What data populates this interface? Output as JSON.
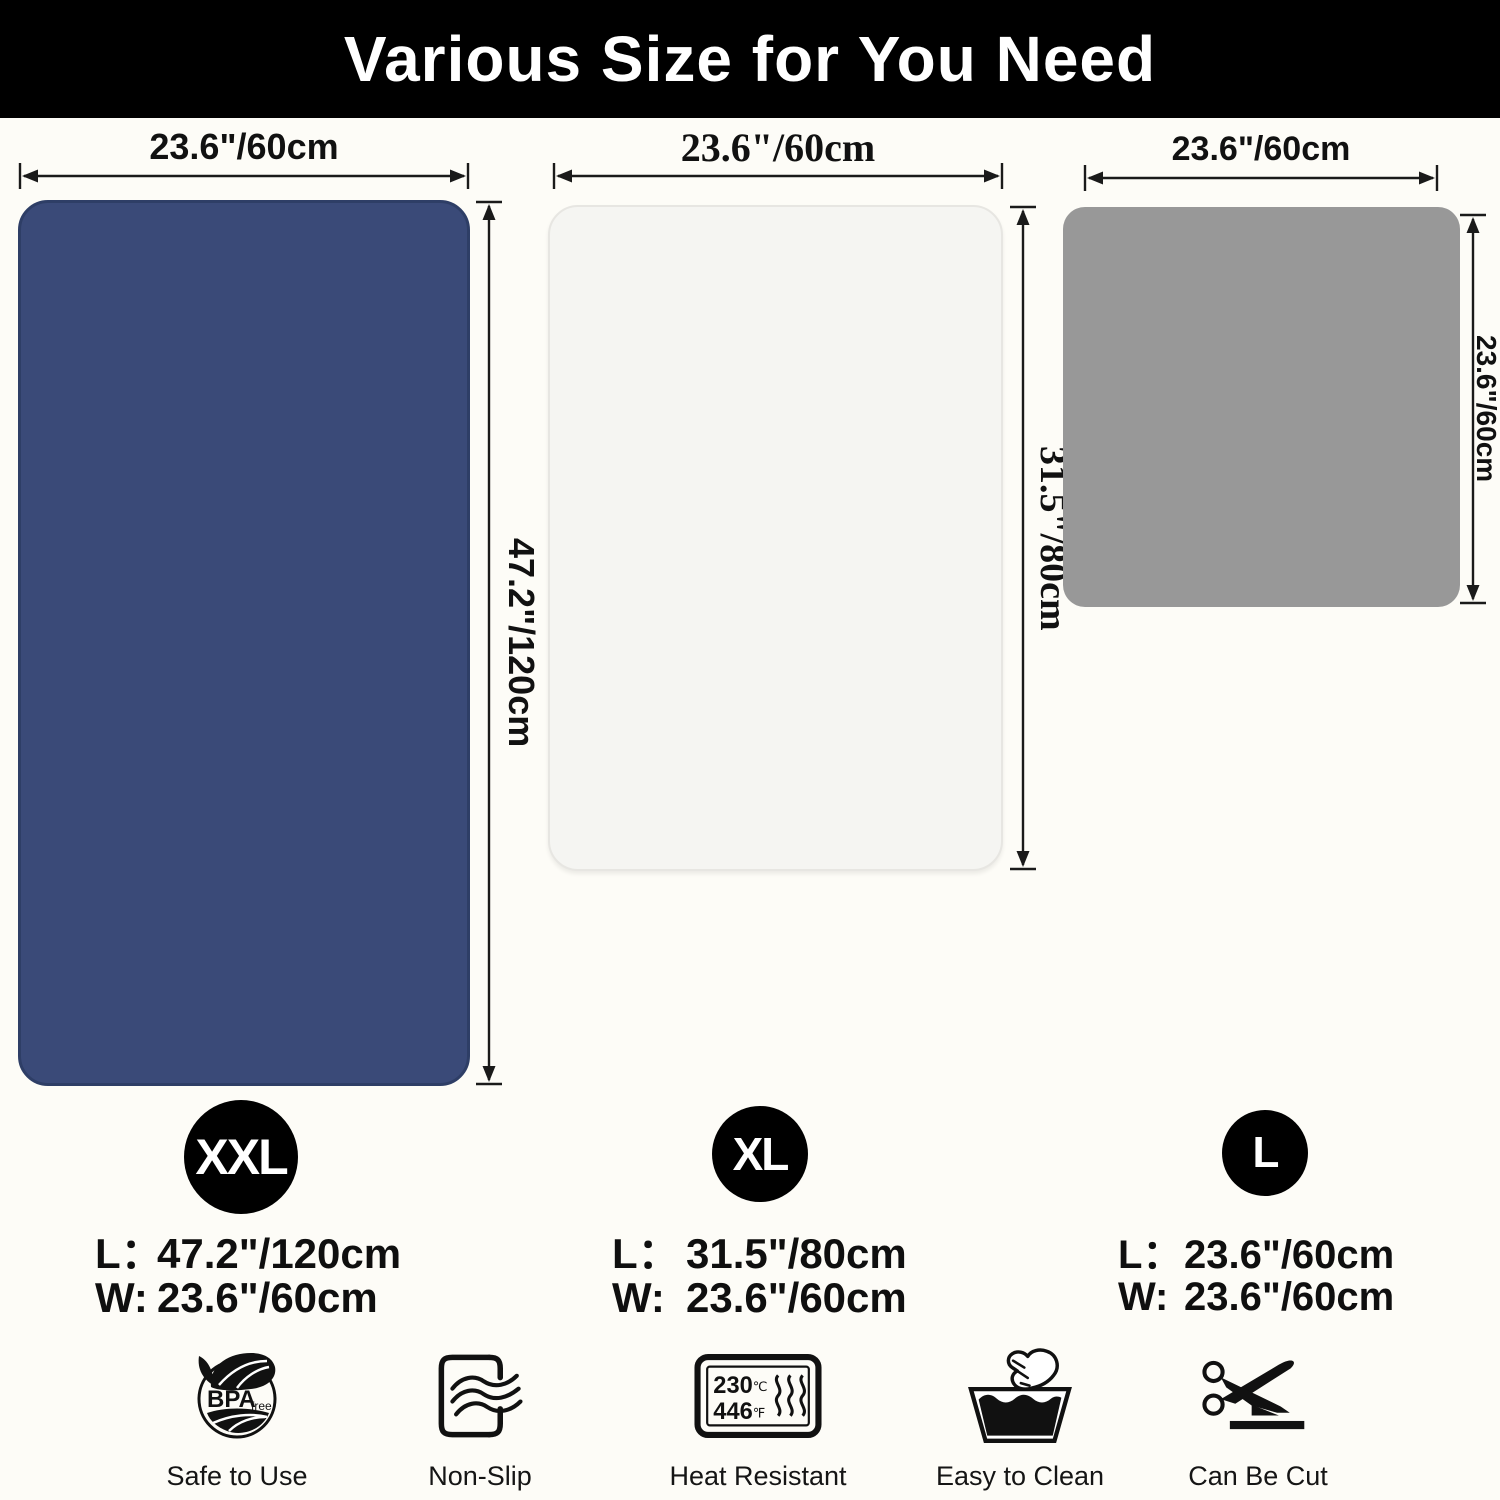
{
  "title": "Various Size for You Need",
  "sizes": [
    {
      "badge": "XXL",
      "top_dim": "23.6\"/60cm",
      "side_dim": "47.2\"/120cm",
      "length_label": "L：",
      "length_value": "47.2\"/120cm",
      "width_label": "W:",
      "width_value": "23.6\"/60cm"
    },
    {
      "badge": "XL",
      "top_dim": "23.6\"/60cm",
      "side_dim": "31.5\"/80cm",
      "length_label": "L：",
      "length_value": "31.5\"/80cm",
      "width_label": "W:",
      "width_value": "23.6\"/60cm"
    },
    {
      "badge": "L",
      "top_dim": "23.6\"/60cm",
      "side_dim": "23.6\"/60cm",
      "length_label": "L：",
      "length_value": "23.6\"/60cm",
      "width_label": "W:",
      "width_value": "23.6\"/60cm"
    }
  ],
  "features": [
    {
      "label": "Safe to Use",
      "icon": "bpa-free-icon",
      "bpa_text": "BPA",
      "bpa_sub": "free"
    },
    {
      "label": "Non-Slip",
      "icon": "non-slip-icon"
    },
    {
      "label": "Heat Resistant",
      "icon": "heat-resistant-icon",
      "temp_c": "230",
      "unit_c": "℃",
      "temp_f": "446",
      "unit_f": "℉"
    },
    {
      "label": "Easy to Clean",
      "icon": "easy-to-clean-icon"
    },
    {
      "label": "Can Be Cut",
      "icon": "can-be-cut-icon"
    }
  ],
  "colors": {
    "banner": "#000000",
    "title_text": "#ffffff",
    "background": "#fdfcf7",
    "mat_xxl": "#3a4a78",
    "mat_xxl_border": "#2e3e66",
    "mat_xl": "#f5f5f2",
    "mat_xl_border": "#e7e6e2",
    "mat_l": "#989898",
    "arrow": "#1a1a1a"
  }
}
